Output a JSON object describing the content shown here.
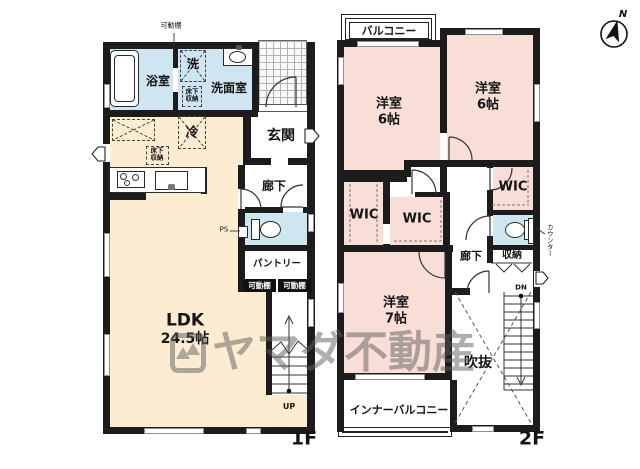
{
  "watermark": {
    "brand": "ヤマダ不動産"
  },
  "compass": {
    "north": "N"
  },
  "colors": {
    "wall": "#1c1c1c",
    "ldk_beige": "#fcedd2",
    "bedroom_pink": "#f9ded7",
    "wet_area_blue": "#cfe5f2",
    "watermark_gray": "#5f5f5f"
  },
  "floor1": {
    "label": "1F",
    "bath": "浴室",
    "washer": "洗",
    "washroom": "洗面室",
    "underfloor_storage_a": "床下収納",
    "underfloor_storage_b": "床下収納",
    "movable_shelf_note": "可動棚",
    "fridge": "冷",
    "entrance": "玄関",
    "hallway": "廊下",
    "ps": "PS",
    "pantry": "パントリー",
    "movable_shelf_a": "可動棚",
    "movable_shelf_b": "可動棚",
    "ldk_name": "LDK",
    "ldk_size": "24.5帖",
    "stairs_up": "UP"
  },
  "floor2": {
    "label": "2F",
    "balcony": "バルコニー",
    "bedroom_a_name": "洋室",
    "bedroom_a_size": "6帖",
    "bedroom_b_name": "洋室",
    "bedroom_b_size": "6帖",
    "bedroom_c_name": "洋室",
    "bedroom_c_size": "7帖",
    "wic_a": "WIC",
    "wic_b": "WIC",
    "wic_c": "WIC",
    "hallway": "廊下",
    "storage": "収納",
    "counter": "カウンター",
    "void": "吹抜",
    "inner_balcony": "インナーバルコニー",
    "stairs_down": "DN"
  }
}
